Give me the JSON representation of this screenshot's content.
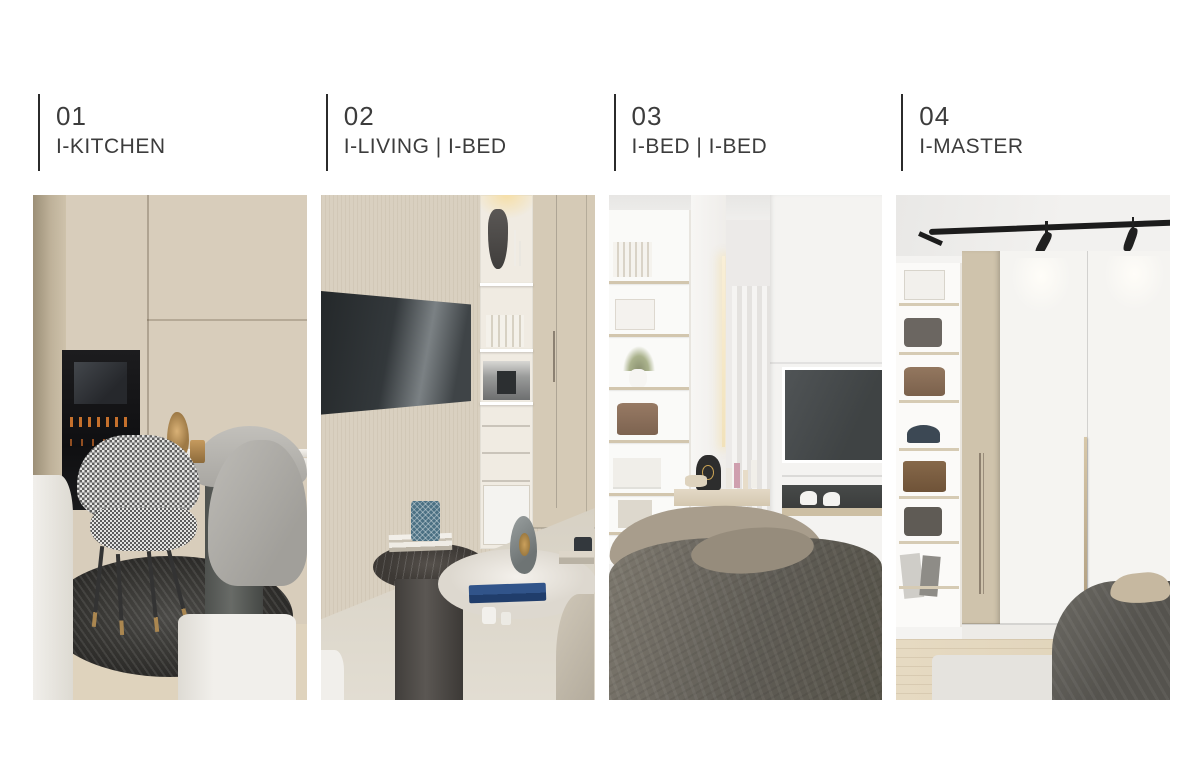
{
  "page": {
    "background": "#ffffff"
  },
  "palette": {
    "text": "#3c3c3c",
    "rule": "#2b2b2b",
    "wood_light": "#d3c8b4",
    "appliance_black": "#141414",
    "tv_gray": "#3e4346",
    "blanket_gray": "#5f5c55",
    "brass": "#ab8750",
    "blue_accent": "#4b7083"
  },
  "sections": [
    {
      "number": "01",
      "label": "I-KITCHEN",
      "alt": "kitchen render"
    },
    {
      "number": "02",
      "label": "I-LIVING | I-BED",
      "alt": "living room and bedroom render"
    },
    {
      "number": "03",
      "label": "I-BED | I-BED",
      "alt": "bedroom vanity and TV wall render"
    },
    {
      "number": "04",
      "label": "I-MASTER",
      "alt": "master bedroom wardrobe render"
    }
  ]
}
